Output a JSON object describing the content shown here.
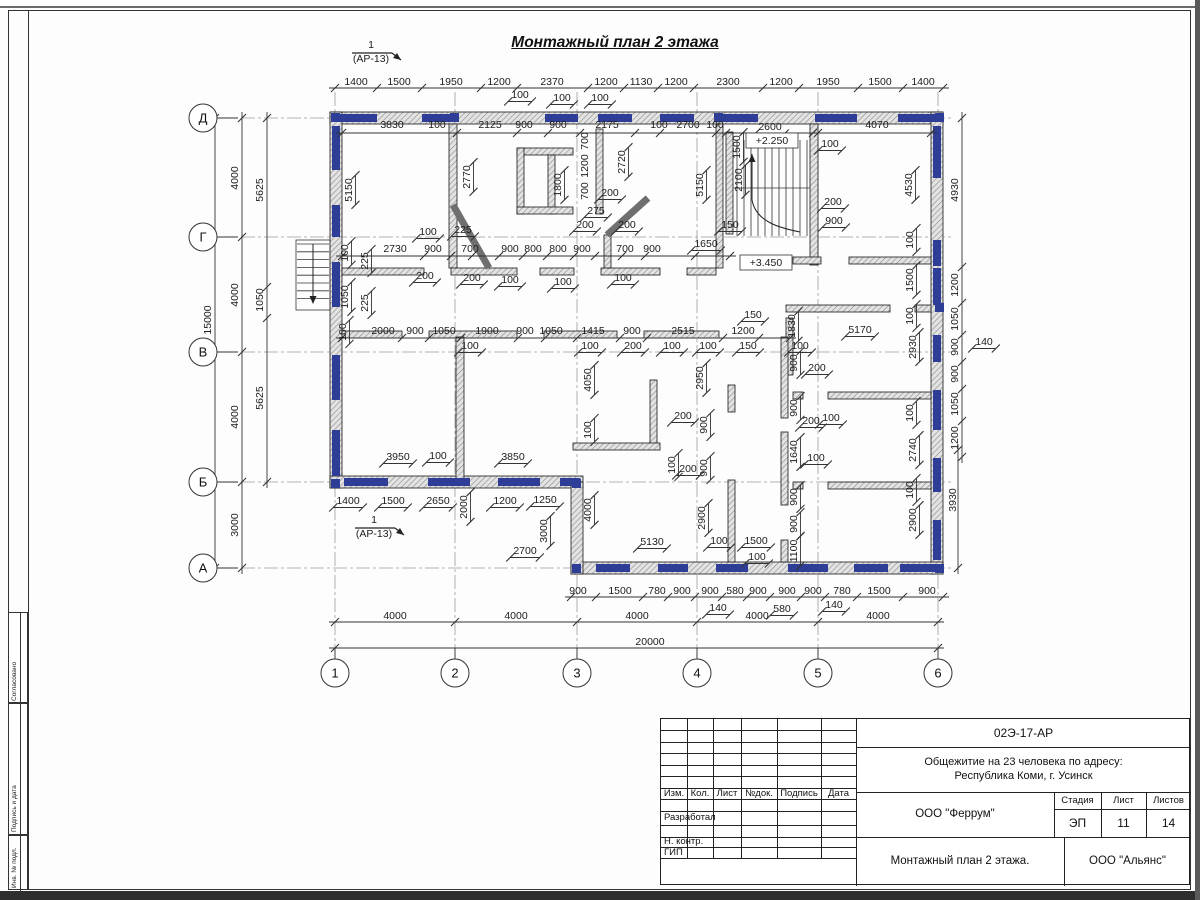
{
  "sheet": {
    "doc_number": "02Э-17-АР",
    "project_line1": "Общежитие на 23 человека по адресу:",
    "project_line2": "Республика Коми, г. Усинск",
    "designer_org": "ООО \"Феррум\"",
    "contractor_org": "ООО \"Альянс\"",
    "sheet_title": "Монтажный план 2 этажа.",
    "stage_label": "Стадия",
    "sheet_label": "Лист",
    "sheets_label": "Листов",
    "stage": "ЭП",
    "sheet_no": "11",
    "sheets_total": "14",
    "cols": [
      "Изм.",
      "Кол.",
      "Лист",
      "№док.",
      "Подпись",
      "Дата"
    ],
    "rows": [
      "Разработал",
      "Н. контр.",
      "ГИП"
    ],
    "side_labels": [
      "Согласовано",
      "Подпись и дата",
      "Инв. № подл."
    ]
  },
  "plan": {
    "title": "Монтажный план 2 этажа",
    "axes_left": [
      {
        "l": "Д",
        "y": 118
      },
      {
        "l": "Г",
        "y": 237
      },
      {
        "l": "В",
        "y": 352
      },
      {
        "l": "Б",
        "y": 482
      },
      {
        "l": "А",
        "y": 568
      }
    ],
    "axes_bottom": [
      {
        "l": "1",
        "x": 335
      },
      {
        "l": "2",
        "x": 455
      },
      {
        "l": "3",
        "x": 577
      },
      {
        "l": "4",
        "x": 697
      },
      {
        "l": "5",
        "x": 818
      },
      {
        "l": "6",
        "x": 938
      }
    ],
    "dim_lines": [
      {
        "o": "h",
        "p": 88,
        "a": 335,
        "b": 943,
        "t": [
          335,
          377,
          422,
          481,
          517,
          588,
          624,
          658,
          694,
          763,
          799,
          858,
          903,
          943
        ]
      },
      {
        "o": "h",
        "p": 597,
        "a": 571,
        "b": 943,
        "t": [
          571,
          596,
          643,
          668,
          695,
          722,
          747,
          770,
          801,
          825,
          857,
          903,
          943
        ]
      },
      {
        "o": "h",
        "p": 622,
        "a": 335,
        "b": 938,
        "t": [
          335,
          455,
          577,
          697,
          818,
          938
        ]
      },
      {
        "o": "h",
        "p": 648,
        "a": 335,
        "b": 938,
        "t": [
          335,
          938
        ]
      },
      {
        "o": "v",
        "p": 242,
        "a": 118,
        "b": 568,
        "t": [
          118,
          237,
          352,
          482,
          568
        ]
      },
      {
        "o": "v",
        "p": 267,
        "a": 118,
        "b": 482,
        "t": [
          118,
          287,
          318,
          482
        ]
      },
      {
        "o": "v",
        "p": 215,
        "a": 118,
        "b": 568,
        "t": [
          118,
          568
        ]
      },
      {
        "o": "v",
        "p": 962,
        "a": 118,
        "b": 457,
        "t": [
          118,
          267,
          303,
          335,
          362,
          389,
          421,
          457
        ]
      },
      {
        "o": "v",
        "p": 958,
        "a": 450,
        "b": 568,
        "t": [
          450,
          568
        ]
      },
      {
        "o": "h",
        "p": 338,
        "a": 342,
        "b": 790,
        "t": [
          342,
          402,
          429,
          461,
          518,
          545,
          577,
          620,
          647,
          723,
          759,
          790
        ]
      },
      {
        "o": "h",
        "p": 256,
        "a": 342,
        "b": 730,
        "t": [
          342,
          424,
          451,
          472,
          499,
          523,
          547,
          574,
          595,
          622,
          645,
          695,
          730
        ]
      },
      {
        "o": "h",
        "p": 133,
        "a": 342,
        "b": 931,
        "t": [
          342,
          457,
          517,
          548,
          580,
          635,
          660,
          716,
          726,
          813,
          818,
          931
        ]
      }
    ],
    "labels": [
      {
        "t": "1400",
        "x": 356,
        "y": 85
      },
      {
        "t": "1500",
        "x": 399,
        "y": 85
      },
      {
        "t": "1950",
        "x": 451,
        "y": 85
      },
      {
        "t": "1200",
        "x": 499,
        "y": 85
      },
      {
        "t": "2370",
        "x": 552,
        "y": 85
      },
      {
        "t": "1200",
        "x": 606,
        "y": 85
      },
      {
        "t": "1130",
        "x": 641,
        "y": 85
      },
      {
        "t": "1200",
        "x": 676,
        "y": 85
      },
      {
        "t": "2300",
        "x": 728,
        "y": 85
      },
      {
        "t": "1200",
        "x": 781,
        "y": 85
      },
      {
        "t": "1950",
        "x": 828,
        "y": 85
      },
      {
        "t": "1500",
        "x": 880,
        "y": 85
      },
      {
        "t": "1400",
        "x": 923,
        "y": 85
      },
      {
        "t": "100",
        "x": 520,
        "y": 98,
        "d": 1
      },
      {
        "t": "100",
        "x": 562,
        "y": 101,
        "d": 1
      },
      {
        "t": "100",
        "x": 600,
        "y": 101,
        "d": 1
      },
      {
        "t": "3830",
        "x": 392,
        "y": 128
      },
      {
        "t": "100",
        "x": 437,
        "y": 128
      },
      {
        "t": "2125",
        "x": 490,
        "y": 128
      },
      {
        "t": "900",
        "x": 524,
        "y": 128
      },
      {
        "t": "900",
        "x": 558,
        "y": 128
      },
      {
        "t": "2175",
        "x": 607,
        "y": 128
      },
      {
        "t": "100",
        "x": 659,
        "y": 128
      },
      {
        "t": "2700",
        "x": 688,
        "y": 128
      },
      {
        "t": "100",
        "x": 715,
        "y": 128
      },
      {
        "t": "2600",
        "x": 770,
        "y": 130,
        "d": 1
      },
      {
        "t": "4070",
        "x": 877,
        "y": 128
      },
      {
        "t": "100",
        "x": 830,
        "y": 147,
        "d": 1
      },
      {
        "t": "5150",
        "x": 352,
        "y": 190,
        "r": 1,
        "d": 1
      },
      {
        "t": "2770",
        "x": 470,
        "y": 177,
        "r": 1,
        "d": 1
      },
      {
        "t": "1800",
        "x": 561,
        "y": 185,
        "r": 1,
        "d": 1
      },
      {
        "t": "700",
        "x": 588,
        "y": 141,
        "r": 1
      },
      {
        "t": "1200",
        "x": 588,
        "y": 166,
        "r": 1
      },
      {
        "t": "700",
        "x": 588,
        "y": 191,
        "r": 1
      },
      {
        "t": "2720",
        "x": 625,
        "y": 162,
        "r": 1,
        "d": 1
      },
      {
        "t": "5150",
        "x": 703,
        "y": 185,
        "r": 1,
        "d": 1
      },
      {
        "t": "1500",
        "x": 740,
        "y": 147,
        "r": 1,
        "d": 1
      },
      {
        "t": "2100",
        "x": 742,
        "y": 180,
        "r": 1,
        "d": 1
      },
      {
        "t": "4530",
        "x": 912,
        "y": 185,
        "r": 1,
        "d": 1
      },
      {
        "t": "4930",
        "x": 958,
        "y": 190,
        "r": 1
      },
      {
        "t": "275",
        "x": 596,
        "y": 214,
        "d": 1
      },
      {
        "t": "200",
        "x": 610,
        "y": 196,
        "d": 1
      },
      {
        "t": "200",
        "x": 833,
        "y": 205,
        "d": 1
      },
      {
        "t": "900",
        "x": 834,
        "y": 224,
        "d": 1
      },
      {
        "t": "2730",
        "x": 395,
        "y": 252
      },
      {
        "t": "900",
        "x": 433,
        "y": 252
      },
      {
        "t": "700",
        "x": 470,
        "y": 252
      },
      {
        "t": "900",
        "x": 510,
        "y": 252
      },
      {
        "t": "800",
        "x": 533,
        "y": 252
      },
      {
        "t": "800",
        "x": 558,
        "y": 252
      },
      {
        "t": "900",
        "x": 582,
        "y": 252
      },
      {
        "t": "700",
        "x": 625,
        "y": 252
      },
      {
        "t": "900",
        "x": 652,
        "y": 252
      },
      {
        "t": "100",
        "x": 428,
        "y": 235,
        "d": 1
      },
      {
        "t": "225",
        "x": 463,
        "y": 233,
        "d": 1
      },
      {
        "t": "200",
        "x": 585,
        "y": 228,
        "d": 1
      },
      {
        "t": "200",
        "x": 627,
        "y": 228,
        "d": 1
      },
      {
        "t": "150",
        "x": 730,
        "y": 228,
        "d": 1
      },
      {
        "t": "1650",
        "x": 706,
        "y": 247,
        "d": 1
      },
      {
        "t": "200",
        "x": 425,
        "y": 279,
        "d": 1
      },
      {
        "t": "200",
        "x": 472,
        "y": 281,
        "d": 1
      },
      {
        "t": "100",
        "x": 510,
        "y": 283,
        "d": 1
      },
      {
        "t": "100",
        "x": 563,
        "y": 285,
        "d": 1
      },
      {
        "t": "100",
        "x": 623,
        "y": 281,
        "d": 1
      },
      {
        "t": "100",
        "x": 348,
        "y": 253,
        "r": 1,
        "d": 1
      },
      {
        "t": "225",
        "x": 368,
        "y": 261,
        "r": 1,
        "d": 1
      },
      {
        "t": "1050",
        "x": 348,
        "y": 297,
        "r": 1,
        "d": 1
      },
      {
        "t": "225",
        "x": 368,
        "y": 303,
        "r": 1,
        "d": 1
      },
      {
        "t": "100",
        "x": 346,
        "y": 332,
        "r": 1,
        "d": 1
      },
      {
        "t": "4000",
        "x": 238,
        "y": 178,
        "r": 1
      },
      {
        "t": "4000",
        "x": 238,
        "y": 295,
        "r": 1
      },
      {
        "t": "4000",
        "x": 238,
        "y": 417,
        "r": 1
      },
      {
        "t": "3000",
        "x": 238,
        "y": 525,
        "r": 1
      },
      {
        "t": "5625",
        "x": 263,
        "y": 190,
        "r": 1
      },
      {
        "t": "1050",
        "x": 263,
        "y": 300,
        "r": 1
      },
      {
        "t": "5625",
        "x": 263,
        "y": 398,
        "r": 1
      },
      {
        "t": "15000",
        "x": 211,
        "y": 320,
        "r": 1
      },
      {
        "t": "2000",
        "x": 383,
        "y": 334
      },
      {
        "t": "900",
        "x": 415,
        "y": 334
      },
      {
        "t": "1050",
        "x": 444,
        "y": 334
      },
      {
        "t": "1900",
        "x": 487,
        "y": 334
      },
      {
        "t": "900",
        "x": 525,
        "y": 334
      },
      {
        "t": "1050",
        "x": 551,
        "y": 334
      },
      {
        "t": "1415",
        "x": 593,
        "y": 334
      },
      {
        "t": "900",
        "x": 632,
        "y": 334
      },
      {
        "t": "2515",
        "x": 683,
        "y": 334
      },
      {
        "t": "1200",
        "x": 743,
        "y": 334
      },
      {
        "t": "100",
        "x": 470,
        "y": 349,
        "d": 1
      },
      {
        "t": "100",
        "x": 590,
        "y": 349,
        "d": 1
      },
      {
        "t": "200",
        "x": 633,
        "y": 349,
        "d": 1
      },
      {
        "t": "100",
        "x": 672,
        "y": 349,
        "d": 1
      },
      {
        "t": "100",
        "x": 708,
        "y": 349,
        "d": 1
      },
      {
        "t": "150",
        "x": 748,
        "y": 349,
        "d": 1
      },
      {
        "t": "150",
        "x": 753,
        "y": 318,
        "d": 1
      },
      {
        "t": "100",
        "x": 800,
        "y": 349,
        "d": 1
      },
      {
        "t": "1830",
        "x": 795,
        "y": 326,
        "r": 1,
        "d": 1
      },
      {
        "t": "5170",
        "x": 860,
        "y": 333,
        "d": 1
      },
      {
        "t": "100",
        "x": 913,
        "y": 240,
        "r": 1,
        "d": 1
      },
      {
        "t": "1500",
        "x": 913,
        "y": 280,
        "r": 1,
        "d": 1
      },
      {
        "t": "100",
        "x": 913,
        "y": 316,
        "r": 1,
        "d": 1
      },
      {
        "t": "2930",
        "x": 916,
        "y": 347,
        "r": 1,
        "d": 1
      },
      {
        "t": "100",
        "x": 913,
        "y": 413,
        "r": 1,
        "d": 1
      },
      {
        "t": "2740",
        "x": 916,
        "y": 450,
        "r": 1,
        "d": 1
      },
      {
        "t": "100",
        "x": 913,
        "y": 490,
        "r": 1,
        "d": 1
      },
      {
        "t": "2900",
        "x": 916,
        "y": 520,
        "r": 1,
        "d": 1
      },
      {
        "t": "3930",
        "x": 956,
        "y": 500,
        "r": 1
      },
      {
        "t": "1200",
        "x": 958,
        "y": 285,
        "r": 1
      },
      {
        "t": "1050",
        "x": 958,
        "y": 319,
        "r": 1
      },
      {
        "t": "900",
        "x": 958,
        "y": 347,
        "r": 1
      },
      {
        "t": "900",
        "x": 958,
        "y": 374,
        "r": 1
      },
      {
        "t": "1050",
        "x": 958,
        "y": 404,
        "r": 1
      },
      {
        "t": "1200",
        "x": 958,
        "y": 438,
        "r": 1
      },
      {
        "t": "140",
        "x": 984,
        "y": 345,
        "d": 1
      },
      {
        "t": "900",
        "x": 797,
        "y": 363,
        "r": 1,
        "d": 1
      },
      {
        "t": "900",
        "x": 797,
        "y": 408,
        "r": 1,
        "d": 1
      },
      {
        "t": "1640",
        "x": 797,
        "y": 452,
        "r": 1,
        "d": 1
      },
      {
        "t": "900",
        "x": 797,
        "y": 497,
        "r": 1,
        "d": 1
      },
      {
        "t": "900",
        "x": 797,
        "y": 524,
        "r": 1,
        "d": 1
      },
      {
        "t": "1100",
        "x": 797,
        "y": 551,
        "r": 1,
        "d": 1
      },
      {
        "t": "200",
        "x": 817,
        "y": 371,
        "d": 1
      },
      {
        "t": "200",
        "x": 811,
        "y": 424,
        "d": 1
      },
      {
        "t": "100",
        "x": 831,
        "y": 421,
        "d": 1
      },
      {
        "t": "100",
        "x": 816,
        "y": 461,
        "d": 1
      },
      {
        "t": "4050",
        "x": 591,
        "y": 380,
        "r": 1,
        "d": 1
      },
      {
        "t": "100",
        "x": 591,
        "y": 430,
        "r": 1,
        "d": 1
      },
      {
        "t": "4000",
        "x": 591,
        "y": 510,
        "r": 1,
        "d": 1
      },
      {
        "t": "2950",
        "x": 703,
        "y": 378,
        "r": 1,
        "d": 1
      },
      {
        "t": "2900",
        "x": 705,
        "y": 518,
        "r": 1,
        "d": 1
      },
      {
        "t": "900",
        "x": 707,
        "y": 425,
        "r": 1,
        "d": 1
      },
      {
        "t": "900",
        "x": 707,
        "y": 468,
        "r": 1,
        "d": 1
      },
      {
        "t": "100",
        "x": 675,
        "y": 465,
        "r": 1,
        "d": 1
      },
      {
        "t": "200",
        "x": 683,
        "y": 419,
        "d": 1
      },
      {
        "t": "200",
        "x": 688,
        "y": 472,
        "d": 1
      },
      {
        "t": "5130",
        "x": 652,
        "y": 545,
        "d": 1
      },
      {
        "t": "100",
        "x": 719,
        "y": 544,
        "d": 1
      },
      {
        "t": "1500",
        "x": 756,
        "y": 544,
        "d": 1
      },
      {
        "t": "100",
        "x": 757,
        "y": 560,
        "d": 1
      },
      {
        "t": "3950",
        "x": 398,
        "y": 460,
        "d": 1
      },
      {
        "t": "100",
        "x": 438,
        "y": 459,
        "d": 1
      },
      {
        "t": "3850",
        "x": 513,
        "y": 460,
        "d": 1
      },
      {
        "t": "1400",
        "x": 348,
        "y": 504,
        "d": 1
      },
      {
        "t": "1500",
        "x": 393,
        "y": 504,
        "d": 1
      },
      {
        "t": "2650",
        "x": 438,
        "y": 504,
        "d": 1
      },
      {
        "t": "1200",
        "x": 505,
        "y": 504,
        "d": 1
      },
      {
        "t": "1250",
        "x": 545,
        "y": 503,
        "d": 1
      },
      {
        "t": "2000",
        "x": 467,
        "y": 507,
        "r": 1,
        "d": 1
      },
      {
        "t": "3000",
        "x": 547,
        "y": 531,
        "r": 1,
        "d": 1
      },
      {
        "t": "2700",
        "x": 525,
        "y": 554,
        "d": 1
      },
      {
        "t": "900",
        "x": 578,
        "y": 594
      },
      {
        "t": "1500",
        "x": 620,
        "y": 594
      },
      {
        "t": "780",
        "x": 657,
        "y": 594
      },
      {
        "t": "900",
        "x": 682,
        "y": 594
      },
      {
        "t": "900",
        "x": 710,
        "y": 594
      },
      {
        "t": "580",
        "x": 735,
        "y": 594
      },
      {
        "t": "900",
        "x": 758,
        "y": 594
      },
      {
        "t": "900",
        "x": 787,
        "y": 594
      },
      {
        "t": "900",
        "x": 813,
        "y": 594
      },
      {
        "t": "780",
        "x": 842,
        "y": 594
      },
      {
        "t": "1500",
        "x": 879,
        "y": 594
      },
      {
        "t": "900",
        "x": 927,
        "y": 594
      },
      {
        "t": "140",
        "x": 718,
        "y": 611,
        "d": 1
      },
      {
        "t": "580",
        "x": 782,
        "y": 612,
        "d": 1
      },
      {
        "t": "140",
        "x": 834,
        "y": 608,
        "d": 1
      },
      {
        "t": "4000",
        "x": 395,
        "y": 619
      },
      {
        "t": "4000",
        "x": 516,
        "y": 619
      },
      {
        "t": "4000",
        "x": 637,
        "y": 619
      },
      {
        "t": "4000",
        "x": 757,
        "y": 619
      },
      {
        "t": "4000",
        "x": 878,
        "y": 619
      },
      {
        "t": "20000",
        "x": 650,
        "y": 645
      },
      {
        "t": "1",
        "x": 371,
        "y": 48,
        "fs": 12
      },
      {
        "t": "(АР-13)",
        "x": 371,
        "y": 62,
        "fs": 11
      },
      {
        "t": "1",
        "x": 374,
        "y": 523,
        "fs": 12
      },
      {
        "t": "(АР-13)",
        "x": 374,
        "y": 537,
        "fs": 11
      },
      {
        "t": "+2.250",
        "x": 772,
        "y": 144,
        "box": 1
      },
      {
        "t": "+3.450",
        "x": 766,
        "y": 266,
        "box": 1
      }
    ]
  }
}
